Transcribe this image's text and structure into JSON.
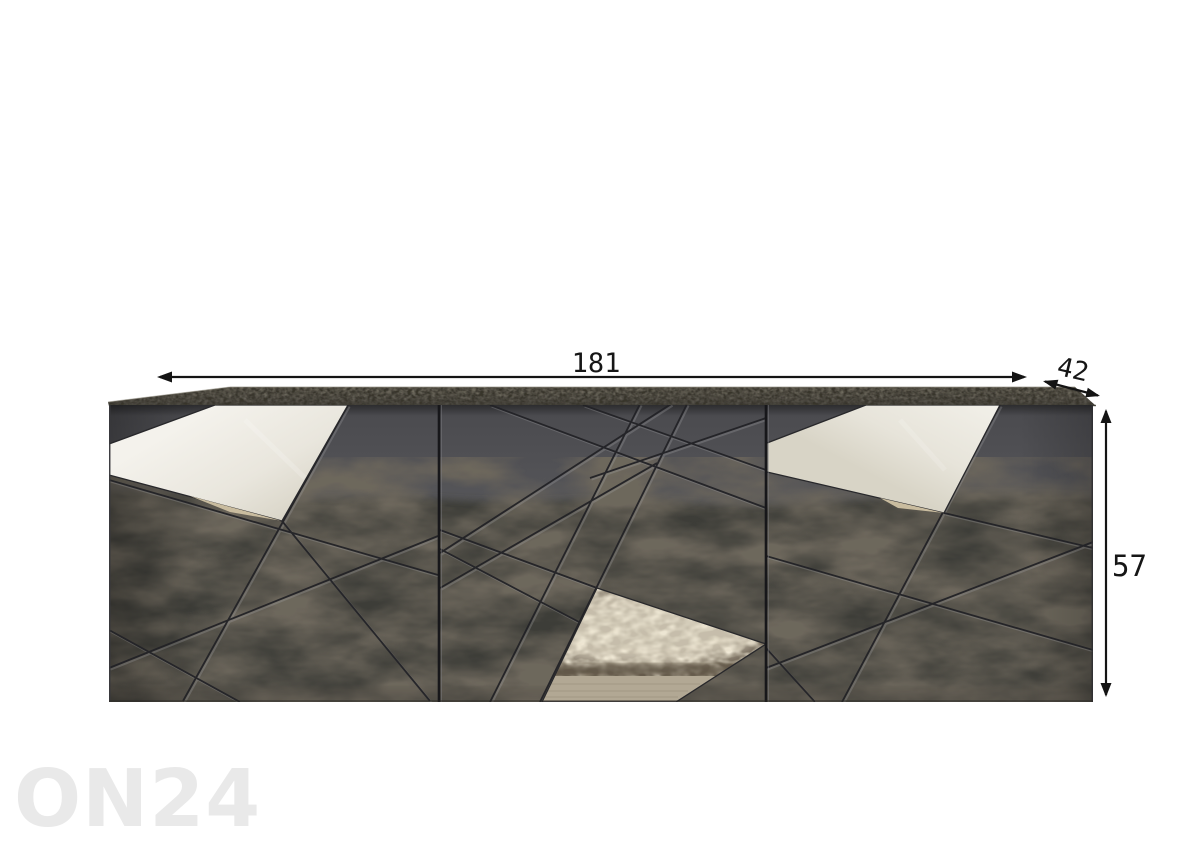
{
  "product_image": {
    "subject": "three-door sideboard, glossy anthracite front with diagonal grooves and mirror inserts",
    "view": "front"
  },
  "dimensions": {
    "width": "181",
    "depth": "42",
    "height": "57"
  },
  "watermark": {
    "text": "ON24"
  },
  "palette": {
    "background": "#ffffff",
    "annotation": "#141414",
    "watermark": "#e9e9e9",
    "cabinet_body": "#4e4e51",
    "rug_reflection": "#3e3c39",
    "mirror_white": "#eeece4",
    "mirror_rug_beige": "#c9bda4",
    "wood_floor": "#b1a793",
    "top_surface": "#6e6a60"
  }
}
